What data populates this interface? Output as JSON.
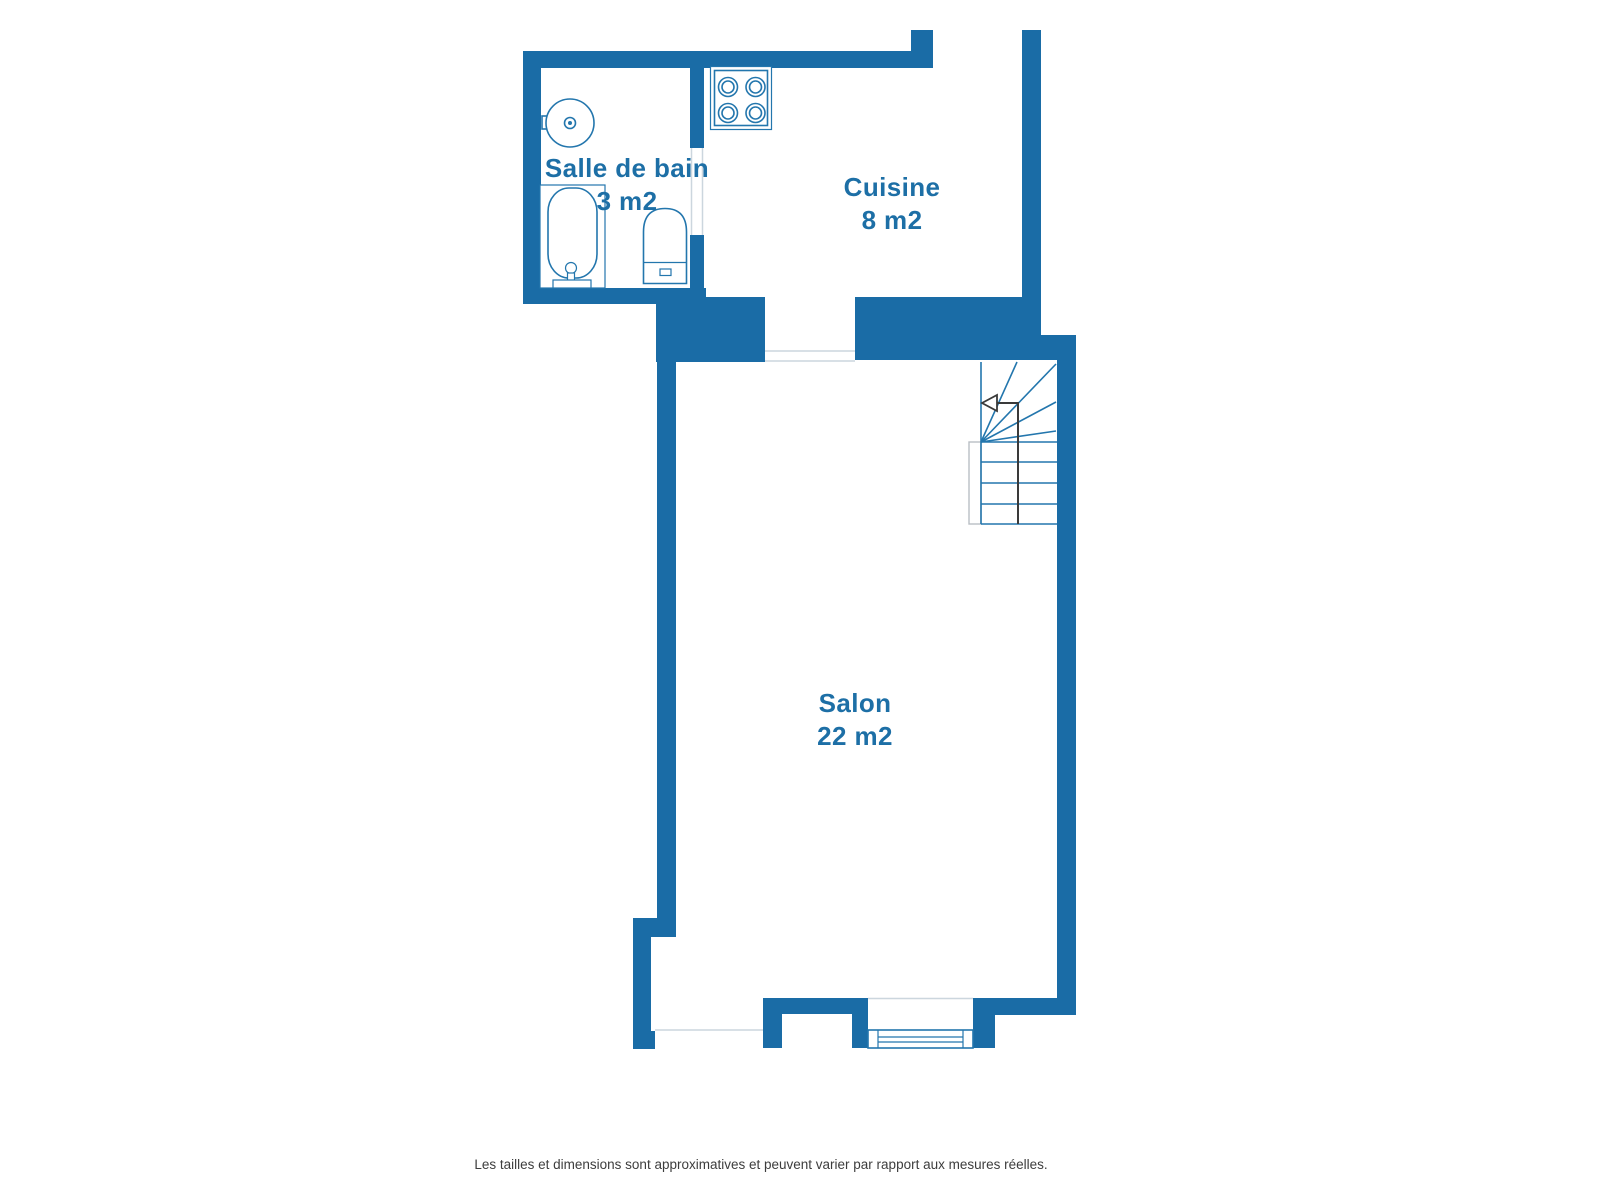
{
  "rooms": [
    {
      "id": "salle-de-bain",
      "name": "Salle de bain",
      "area": "3 m2"
    },
    {
      "id": "cuisine",
      "name": "Cuisine",
      "area": "8 m2"
    },
    {
      "id": "salon",
      "name": "Salon",
      "area": "22 m2"
    }
  ],
  "disclaimer": "Les tailles et dimensions sont approximatives et peuvent varier par rapport aux mesures réelles.",
  "fixtures": [
    "washing-machine",
    "bathtub",
    "toilet",
    "stove",
    "staircase",
    "window"
  ],
  "colors": {
    "wall": "#1a6ca6",
    "line": "#2376ad",
    "label": "#1d6fa6",
    "walk": "#3a3a3a",
    "rail": "#b9bec4",
    "faint": "#ccd6de",
    "note": "#3d3d3d"
  }
}
